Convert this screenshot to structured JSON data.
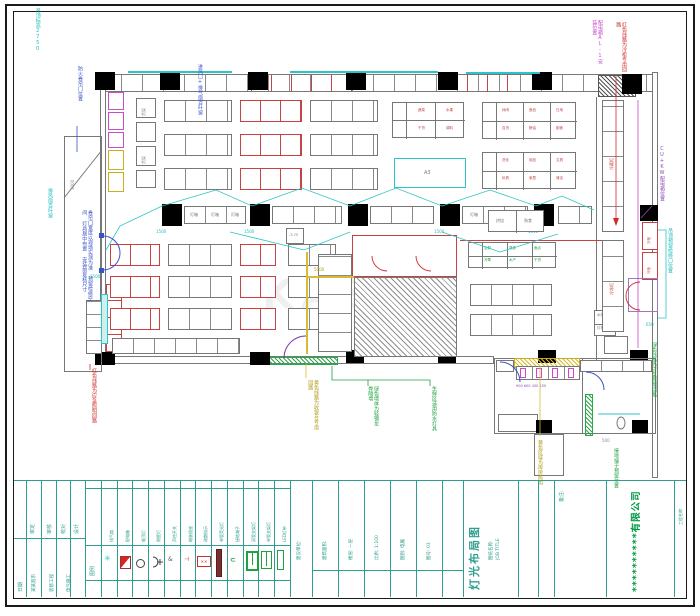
{
  "watermark": "KASO",
  "annotations": {
    "tl_cyan": "吊顶标高2750",
    "l_blue1": "防火卷帘门位置",
    "t_blue2": "进风口+排气扇百叶窗",
    "t_magenta": "配电箱AL-1安装位置",
    "t_red": "红色线路为冷柜专用回路",
    "r_purple": "CU+KW配电箱位置",
    "r_cyan": "吊顶预留检修口位置",
    "r_green": "绿色线路为应急照明回路",
    "br_green": "接地端子预留位置",
    "b_olive1": "黄色线路为收银台专用回路",
    "b_green1": "绿色墙体为轻钢龙骨隔墙",
    "b_green2": "生鲜区选用防水灯具",
    "b_olive2": "黄色区域为库房照明",
    "l_cyan2": "排风扇百叶窗",
    "l_blue_block": "卷帘门宽度以现场实测为准 预留检修空间 灯具居中布置 安装前复核尺寸",
    "l_red": "红色线路为应急照明回路"
  },
  "labels": {
    "t1": [
      "蔬菜",
      "水果",
      "干货",
      "调料"
    ],
    "t2": [
      "休闲",
      "食品",
      "日用",
      "百货",
      "粮油",
      "副食"
    ],
    "t3": [
      "洗化",
      "用品",
      "文具",
      "玩具",
      "家居",
      "清洁"
    ],
    "green_grid": [
      "生鲜",
      "熟食",
      "面点",
      "冷荤",
      "水产",
      "干货"
    ],
    "pair1": [
      "烘焙",
      "熟食"
    ],
    "pair2": [
      "水柜",
      "灯柜"
    ],
    "cold1": "冷藏柜",
    "cold2": "冷冻柜",
    "cold3": "冷柜",
    "cold4": "冷柜",
    "rack": "货架",
    "lightbox": "灯箱",
    "ac": "A3",
    "lvl": "-3.75",
    "dims": {
      "d1500": "1500",
      "d650": "650",
      "d500": "500",
      "d5000": "5000",
      "d3000": "3000",
      "d900": "900 600 450 150"
    }
  },
  "titleblock": {
    "a_date": "日期",
    "a_top": [
      "审定",
      "审核",
      "校对",
      "设计"
    ],
    "a_bottom": [
      "某某超市",
      "装修工程",
      "电气施工"
    ],
    "legend_title": "图例",
    "legend": [
      "排气扇",
      "配电箱",
      "吸顶灯",
      "侧壁灯",
      "声控开关",
      "暗装插座",
      "疏散指示",
      "单管荧光灯",
      "接地端子",
      "双管支架灯",
      "单管支架灯",
      "LED灯带"
    ],
    "c_fields": [
      "建设单位:",
      "建筑面积:",
      "楼层: 一层",
      "比例: 1:100",
      "图别: 电施",
      "图号: 03"
    ],
    "d_title_label": "图纸名称:",
    "d_title_label2": "JOB TITLE",
    "d_title": "灯光布局图",
    "d_note": "备注:",
    "d_company": "**********有限公司",
    "d_project": "工程名称:"
  }
}
